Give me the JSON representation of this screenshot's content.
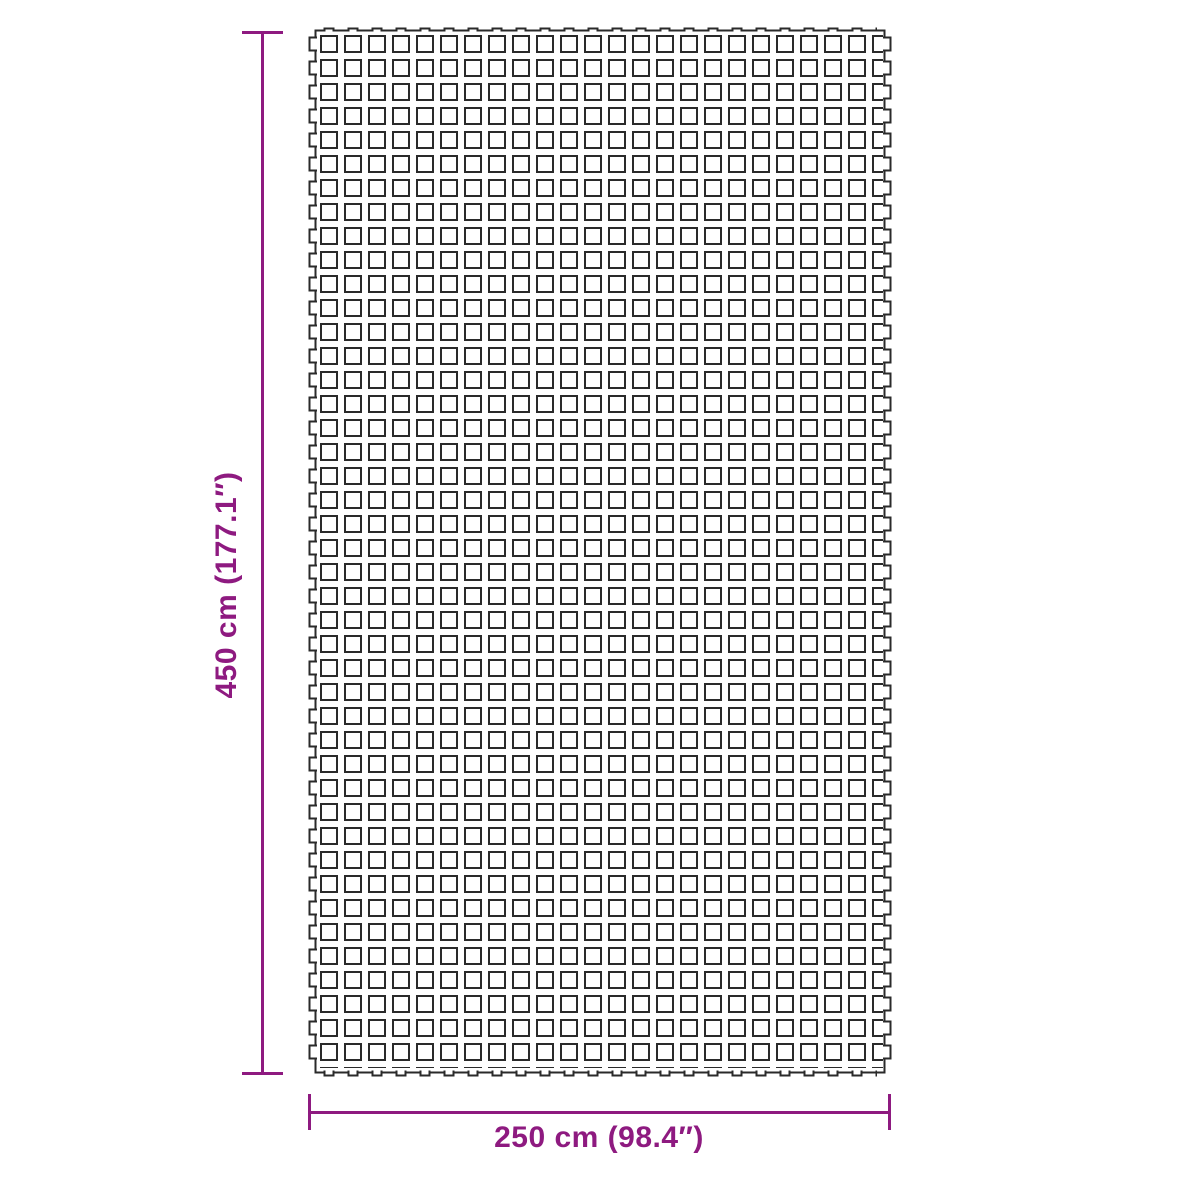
{
  "diagram": {
    "type": "product-dimension-diagram",
    "subject": "perforated square-mesh ground mat with interlocking edge tabs",
    "height_dimension": {
      "label": "450 cm (177.1″)",
      "cm": "450",
      "inches": "177.1",
      "orientation": "vertical"
    },
    "width_dimension": {
      "label": "250 cm (98.4″)",
      "cm": "250",
      "inches": "98.4",
      "orientation": "horizontal"
    },
    "colors": {
      "dimension_accent": "#8E1A80",
      "mat_outline": "#2A2A2A",
      "mat_fill": "#FFFFFF",
      "background": "#FFFFFF"
    }
  }
}
